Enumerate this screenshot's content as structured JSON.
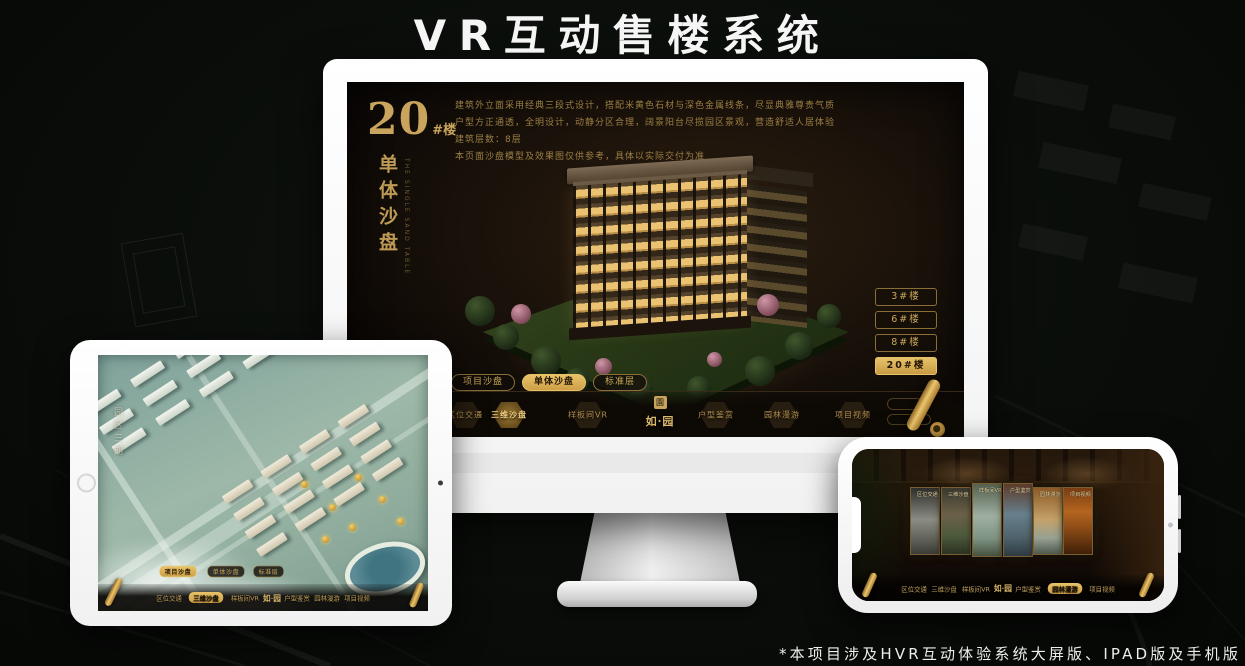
{
  "page": {
    "title": "VR互动售楼系统",
    "footnote": "*本项目涉及HVR互动体验系统大屏版、IPAD版及手机版"
  },
  "brand": {
    "seal_char": "園",
    "name": "如·园"
  },
  "colors": {
    "gold": "#c9a45c",
    "gold_fill": "#d9ad55",
    "screen_bg": "#1a120a",
    "page_bg": "#0a0d0a"
  },
  "monitor": {
    "building_number": "20",
    "building_unit": "#楼",
    "title_vertical": "单体沙盘",
    "subtitle_en": "THE SINGLE SAND TABLE",
    "description_lines": [
      "建筑外立面采用经典三段式设计，搭配米黄色石材与深色金属线条，尽显典雅尊贵气质",
      "户型方正通透，全明设计，动静分区合理，阔景阳台尽揽园区景观，营造舒适人居体验",
      "建筑层数：8层",
      "本页面沙盘模型及效果图仅供参考，具体以实际交付为准"
    ],
    "floor_buttons": [
      {
        "label": "3#楼",
        "active": false
      },
      {
        "label": "6#楼",
        "active": false
      },
      {
        "label": "8#楼",
        "active": false
      },
      {
        "label": "20#楼",
        "active": true
      }
    ],
    "view_tabs": [
      {
        "label": "项目沙盘",
        "active": false
      },
      {
        "label": "单体沙盘",
        "active": true
      },
      {
        "label": "标准层",
        "active": false
      }
    ],
    "nav": {
      "items": [
        {
          "label": "区位交通",
          "active": false
        },
        {
          "label": "三维沙盘",
          "active": true
        },
        {
          "label": "样板间VR",
          "active": false
        },
        {
          "label": "户型鉴赏",
          "active": false
        },
        {
          "label": "园林漫游",
          "active": false
        },
        {
          "label": "项目视频",
          "active": false
        }
      ]
    }
  },
  "tablet": {
    "area_label": "园区三期",
    "view_tabs": [
      {
        "label": "项目沙盘",
        "active": true
      },
      {
        "label": "单体沙盘",
        "active": false
      },
      {
        "label": "标准层",
        "active": false
      }
    ],
    "nav": {
      "items": [
        {
          "label": "区位交通",
          "active": false
        },
        {
          "label": "三维沙盘",
          "active": true
        },
        {
          "label": "样板间VR",
          "active": false
        },
        {
          "label": "户型鉴赏",
          "active": false
        },
        {
          "label": "园林漫游",
          "active": false
        },
        {
          "label": "项目视频",
          "active": false
        }
      ]
    }
  },
  "phone": {
    "panels": [
      {
        "label": "区位交通"
      },
      {
        "label": "三维沙盘"
      },
      {
        "label": "样板间VR"
      },
      {
        "label": "户型鉴赏"
      },
      {
        "label": "园林漫游"
      },
      {
        "label": "项目视频"
      }
    ],
    "nav": {
      "items": [
        {
          "label": "区位交通",
          "active": false
        },
        {
          "label": "三维沙盘",
          "active": false
        },
        {
          "label": "样板间VR",
          "active": false
        },
        {
          "label": "户型鉴赏",
          "active": false
        },
        {
          "label": "园林漫游",
          "active": true
        },
        {
          "label": "项目视频",
          "active": false
        }
      ]
    }
  }
}
